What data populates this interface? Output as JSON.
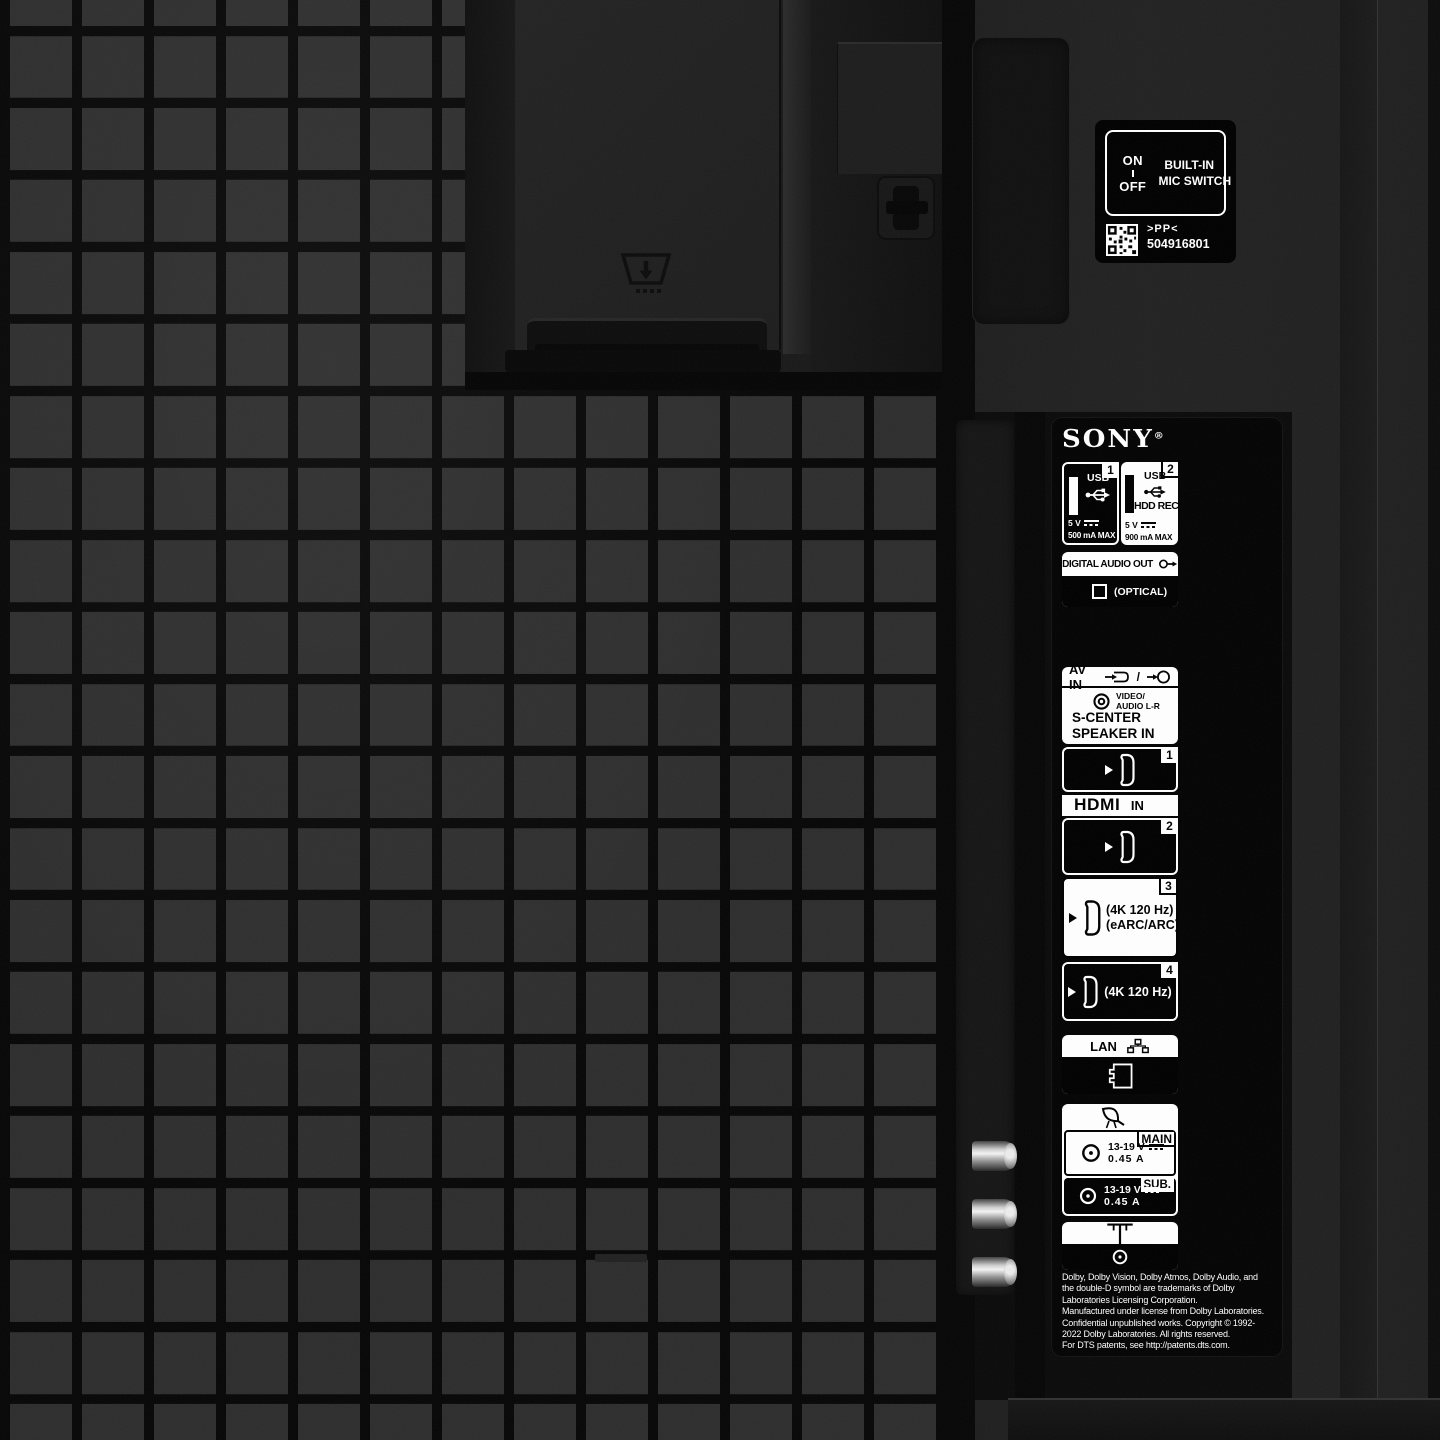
{
  "brand": {
    "name": "SONY",
    "reg": "®"
  },
  "mic_switch": {
    "on": "ON",
    "off": "OFF",
    "line1": "BUILT-IN",
    "line2": "MIC SWITCH",
    "pp": ">PP<",
    "code": "504916801"
  },
  "panel": {
    "usb1": {
      "badge": "1",
      "label": "USB",
      "voltage": "5 V",
      "current": "500 mA MAX"
    },
    "usb2": {
      "badge": "2",
      "label": "USB",
      "hdd": "HDD REC",
      "voltage": "5 V",
      "current": "900 mA MAX"
    },
    "digital_audio_out": {
      "title": "DIGITAL AUDIO OUT",
      "optical": "(OPTICAL)"
    },
    "av_in": {
      "title": "AV IN",
      "slash": "/",
      "jack_line1": "VIDEO/",
      "jack_line2": "AUDIO L-R",
      "center_line1": "S-CENTER",
      "center_line2": "SPEAKER IN"
    },
    "hdmi": {
      "logo": "HDMI",
      "in": "IN",
      "p1_badge": "1",
      "p2_badge": "2",
      "p3_badge": "3",
      "p3_line1": "(4K 120 Hz)",
      "p3_line2": "(eARC/ARC)",
      "p4_badge": "4",
      "p4_line1": "(4K 120 Hz)"
    },
    "lan": {
      "title": "LAN"
    },
    "satellite": {
      "main_badge": "MAIN",
      "main_voltage": "13-19 V",
      "main_current": "0.45 A",
      "sub_badge": "SUB.",
      "sub_voltage": "13-19 V",
      "sub_current": "0.45 A"
    }
  },
  "legal": {
    "lines": [
      "Dolby, Dolby Vision, Dolby Atmos, Dolby Audio, and",
      "the double-D symbol are trademarks of Dolby",
      "Laboratories Licensing Corporation.",
      "Manufactured under license from Dolby Laboratories.",
      "Confidential unpublished works. Copyright © 1992-",
      "2022 Dolby Laboratories. All rights reserved.",
      "For DTS patents, see http://patents.dts.com."
    ]
  },
  "icons": {
    "usb": "usb-trident-icon",
    "dc": "direct-current-icon",
    "optical_out": "audio-output-arrow-icon",
    "rca": "rca-jack-icon",
    "hdmi_plug": "hdmi-connector-icon",
    "lan": "network-nodes-icon",
    "rj45": "ethernet-port-icon",
    "dish": "satellite-dish-icon",
    "coax": "coax-connector-icon",
    "antenna": "terrestrial-antenna-icon",
    "qr": "qr-code",
    "cable_clip": "stand-cable-clip-icon"
  },
  "colors": {
    "label_white": "#ffffff",
    "label_black": "#000000",
    "body_dark": "#1f1f1f",
    "grid_square": "#2d2d2d"
  }
}
